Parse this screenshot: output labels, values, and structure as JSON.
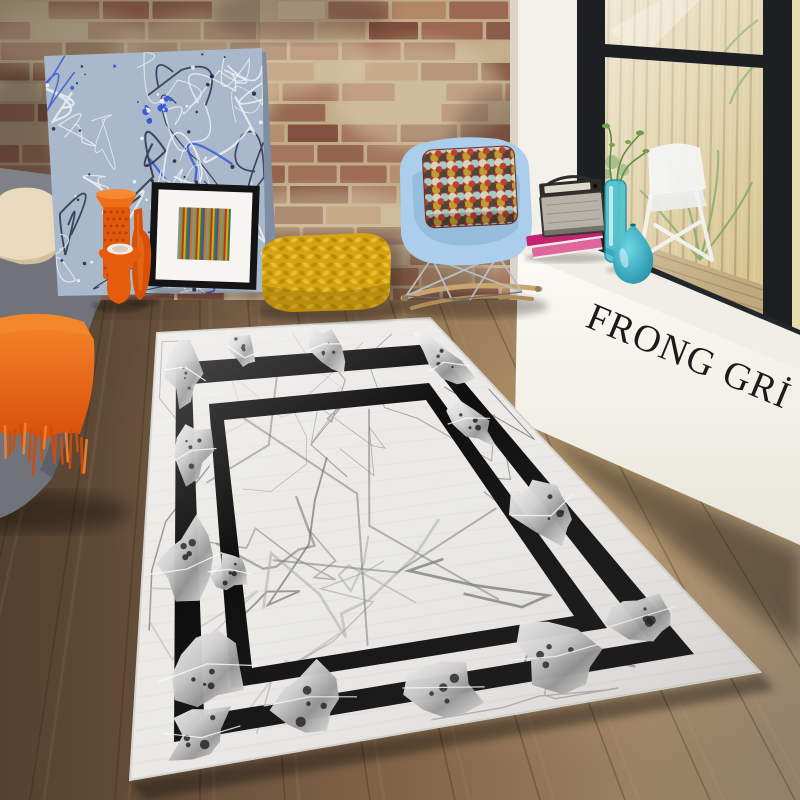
{
  "branding": {
    "ledge_text": "FRONG GRİ"
  },
  "scene": {
    "objects": {
      "wall": "brick wall",
      "painting": "abstract splatter canvas",
      "sofa": "grey fabric sofa",
      "sofa_pillow": "cream cushion",
      "throw": "orange fringed throw blanket",
      "framed_art": "striped art print in black frame",
      "floor_vases": "orange glass vases",
      "pouf": "yellow chunky knit pouf",
      "rocking_chair": "light blue shell rocking chair",
      "chair_pillow": "multicolor geometric cushion",
      "window": "black framed window",
      "outdoor_chair": "white folding chair",
      "ledge": "white window plinth",
      "radio": "vintage radio",
      "books": "stacked pink books",
      "glass_vases": "teal glass vases",
      "rug": "grey marble-pattern rug with double black border",
      "floor": "brown wood plank floor"
    }
  },
  "colors": {
    "brick_red": "#9a6550",
    "brick_dark": "#7c4a3a",
    "brick_light": "#b08663",
    "brick_faded": "#c4af8d",
    "mortar": "#cfc0a0",
    "plaster": "#dacbab",
    "wall_white": "#f3f0ea",
    "window_frame": "#1d2023",
    "fence": "#d4c291",
    "fence_line": "#ab9162",
    "deck": "#c0a97d",
    "deck_line": "#8f7a55",
    "outdoor_chair": "#f0f2ef",
    "foliage": "#7da052",
    "ledge_face": "#f7f5ef",
    "ledge_top": "#f1eee6",
    "brand_text": "#1b1b1b",
    "floor_dark": "#53402e",
    "floor_mid": "#7a5e44",
    "floor_light": "#a5875f",
    "rug_field": "#ebeae7",
    "rug_border": "#0e0e0e",
    "rug_vein": "#8d8d8d",
    "rug_silver_hi": "#f2f2f2",
    "rug_silver_lo": "#9b9b9b",
    "sofa": "#70747a",
    "sofa_shadow": "#56595f",
    "sofa_cushion": "#e9dabd",
    "throw_orange": "#e8600f",
    "throw_orange_light": "#f5872b",
    "painting_base": "#a9b8cb",
    "splatter_navy": "#1b2540",
    "splatter_white": "#f3f6f9",
    "splatter_blue": "#2d52d9",
    "art_frame": "#141414",
    "art_mat": "#f6f5f1",
    "pouf": "#d6a413",
    "pouf_stitch_dark": "#b3860c",
    "pouf_stitch_light": "#ecc63a",
    "chair_shell": "#abceec",
    "chair_shell_shade": "#87aed2",
    "rocker_wood": "#c9a570",
    "radio_top": "#2e2c29",
    "radio_face": "#b7b2a8",
    "book_top": "#c2246e",
    "book_bottom": "#e0679a",
    "vase_teal": "#2fb0c6",
    "vase_teal_dark": "#177b93",
    "vase_orange": "#e2590e"
  }
}
